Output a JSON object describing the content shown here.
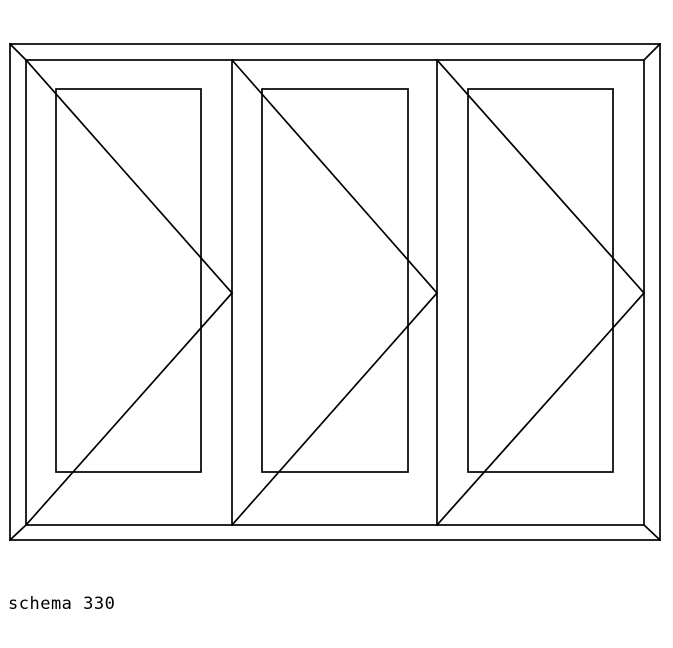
{
  "window": {
    "background": "#ffffff"
  },
  "caption": {
    "text": "schema 330"
  },
  "diagram": {
    "line_color": "#000000",
    "stroke_width": 1.7,
    "canvas": {
      "width": 673,
      "height": 648
    },
    "outer_frame": {
      "x": 10,
      "y": 44,
      "width": 650,
      "height": 496
    },
    "inner_frame": {
      "x": 26,
      "y": 60,
      "width": 618,
      "height": 465
    },
    "corner_miters": [
      {
        "x1": 10,
        "y1": 44,
        "x2": 26,
        "y2": 60
      },
      {
        "x1": 660,
        "y1": 44,
        "x2": 644,
        "y2": 60
      },
      {
        "x1": 10,
        "y1": 540,
        "x2": 26,
        "y2": 525
      },
      {
        "x1": 660,
        "y1": 540,
        "x2": 644,
        "y2": 525
      }
    ],
    "mullions": [
      {
        "x": 232,
        "y1": 60,
        "y2": 525
      },
      {
        "x": 437,
        "y1": 60,
        "y2": 525
      }
    ],
    "glass_panes": [
      {
        "x": 56,
        "y": 89,
        "width": 145,
        "height": 383
      },
      {
        "x": 262,
        "y": 89,
        "width": 146,
        "height": 383
      },
      {
        "x": 468,
        "y": 89,
        "width": 145,
        "height": 383
      }
    ],
    "opening_indicators": [
      {
        "hinge_x": 26,
        "top_y": 60,
        "bottom_y": 525,
        "apex_x": 232,
        "apex_y": 293
      },
      {
        "hinge_x": 232,
        "top_y": 60,
        "bottom_y": 525,
        "apex_x": 437,
        "apex_y": 293
      },
      {
        "hinge_x": 437,
        "top_y": 60,
        "bottom_y": 525,
        "apex_x": 644,
        "apex_y": 293
      }
    ]
  }
}
